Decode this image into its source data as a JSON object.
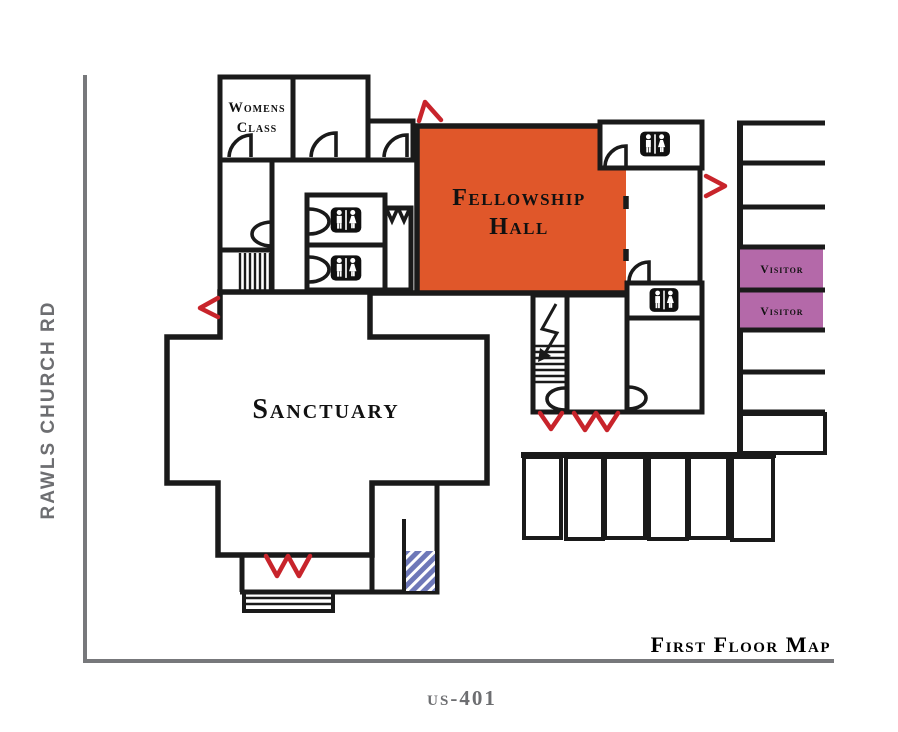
{
  "map_title": "First Floor Map",
  "roads": {
    "west": "RAWLS CHURCH RD",
    "south": "us-401"
  },
  "rooms": {
    "womens_class": {
      "line1": "Womens",
      "line2": "Class",
      "color": "#F2A444"
    },
    "fellowship_hall": {
      "line1": "Fellowship",
      "line2": "Hall",
      "color": "#E0572A"
    },
    "sanctuary": {
      "label": "Sanctuary",
      "color": "#6CBE6B"
    }
  },
  "parking": {
    "visitor_spots": [
      {
        "label": "Visitor"
      },
      {
        "label": "Visitor"
      }
    ],
    "visitor_color": "#B469A9",
    "handicap_color": "#6E78B8",
    "handicap_spots_bottom_row": 3,
    "handicap_spot_right_column": 1,
    "regular_spaces_right_column": 6
  },
  "features": {
    "ramp_color": "#6E78B8",
    "restroom_signs": 4
  },
  "colors": {
    "wall": "#1A1A1A",
    "exterior_door": "#C8242B",
    "road_line": "#77787B",
    "road_text": "#6D6E71"
  }
}
